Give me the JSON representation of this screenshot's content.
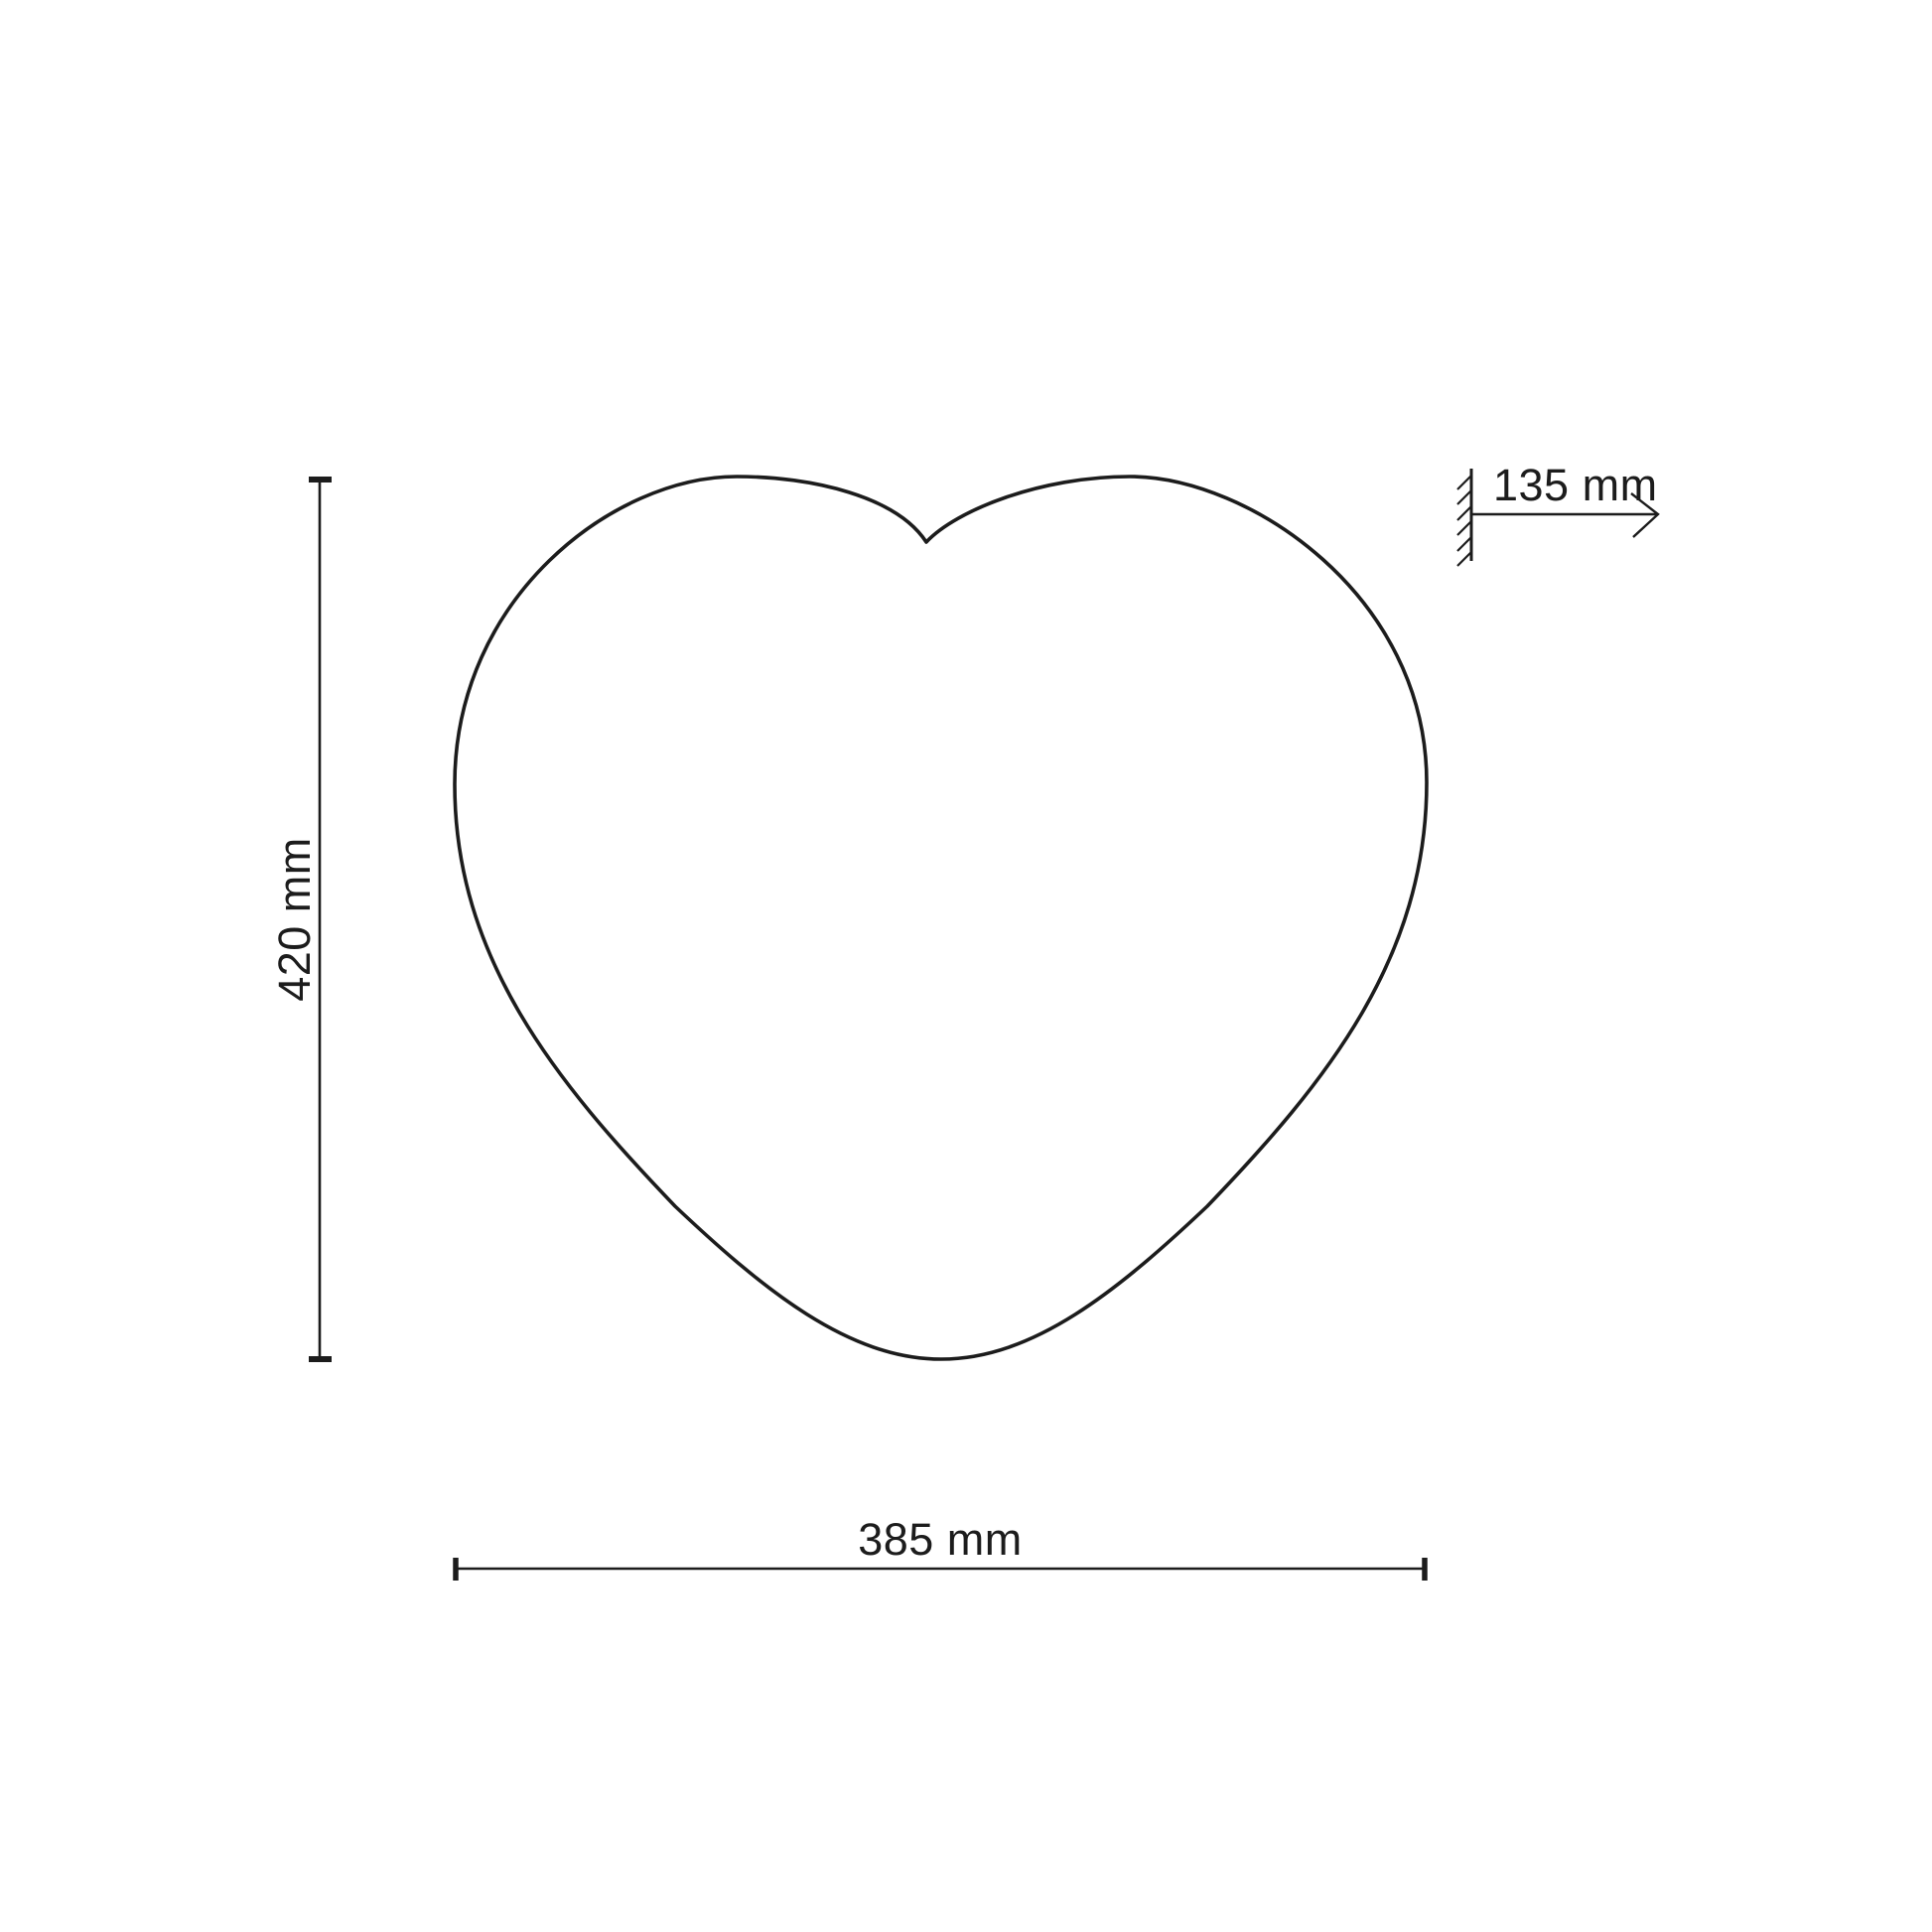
{
  "page": {
    "background_color": "#ffffff",
    "line_color": "#1c1c1c"
  },
  "drawing": {
    "subject": "heart-shaped-outline",
    "dimensions": {
      "height_label": "420 mm",
      "width_label": "385 mm",
      "depth_label": "135 mm"
    }
  }
}
